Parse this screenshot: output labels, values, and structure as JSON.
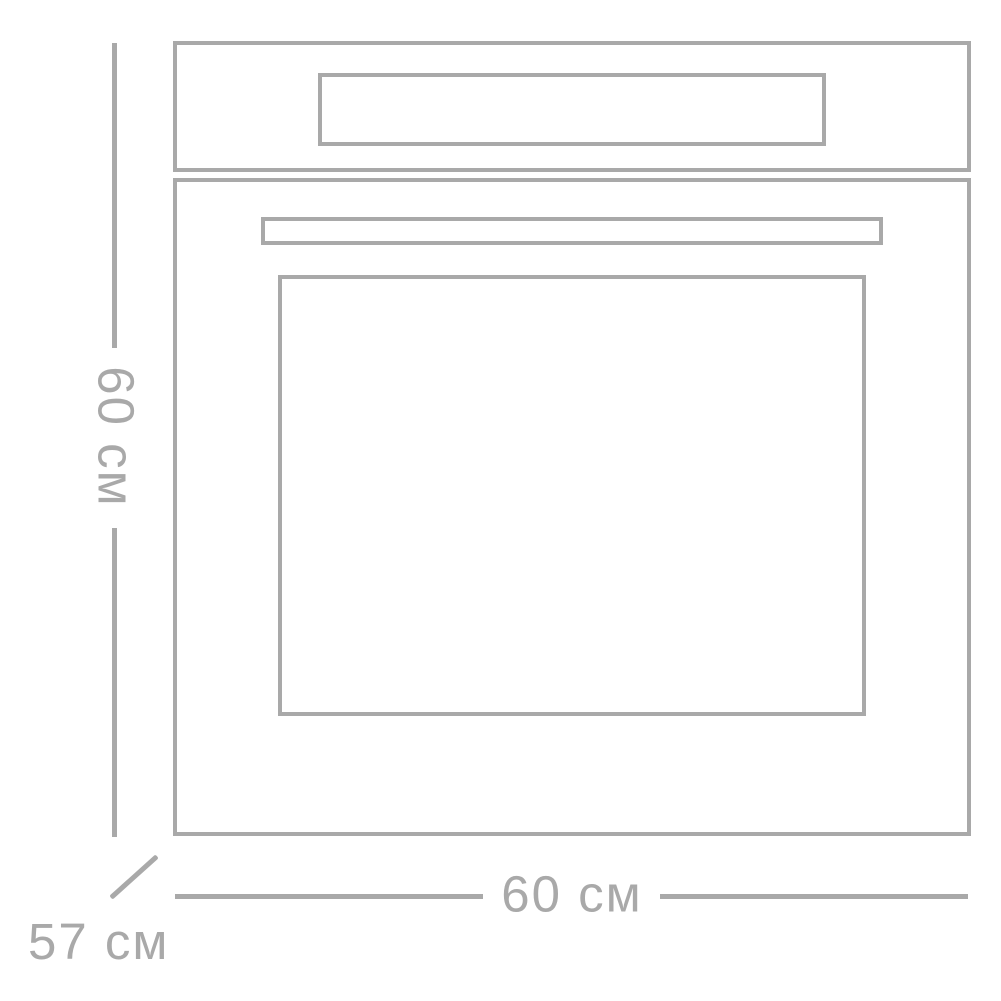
{
  "diagram": {
    "type": "appliance-dimension-schematic",
    "subject": "built-in oven front view with overall dimensions",
    "line_color": "#a9a9a9",
    "background_color": "#ffffff",
    "dimensions": {
      "height_label": "60 см",
      "width_label": "60 см",
      "depth_label": "57 см"
    }
  }
}
